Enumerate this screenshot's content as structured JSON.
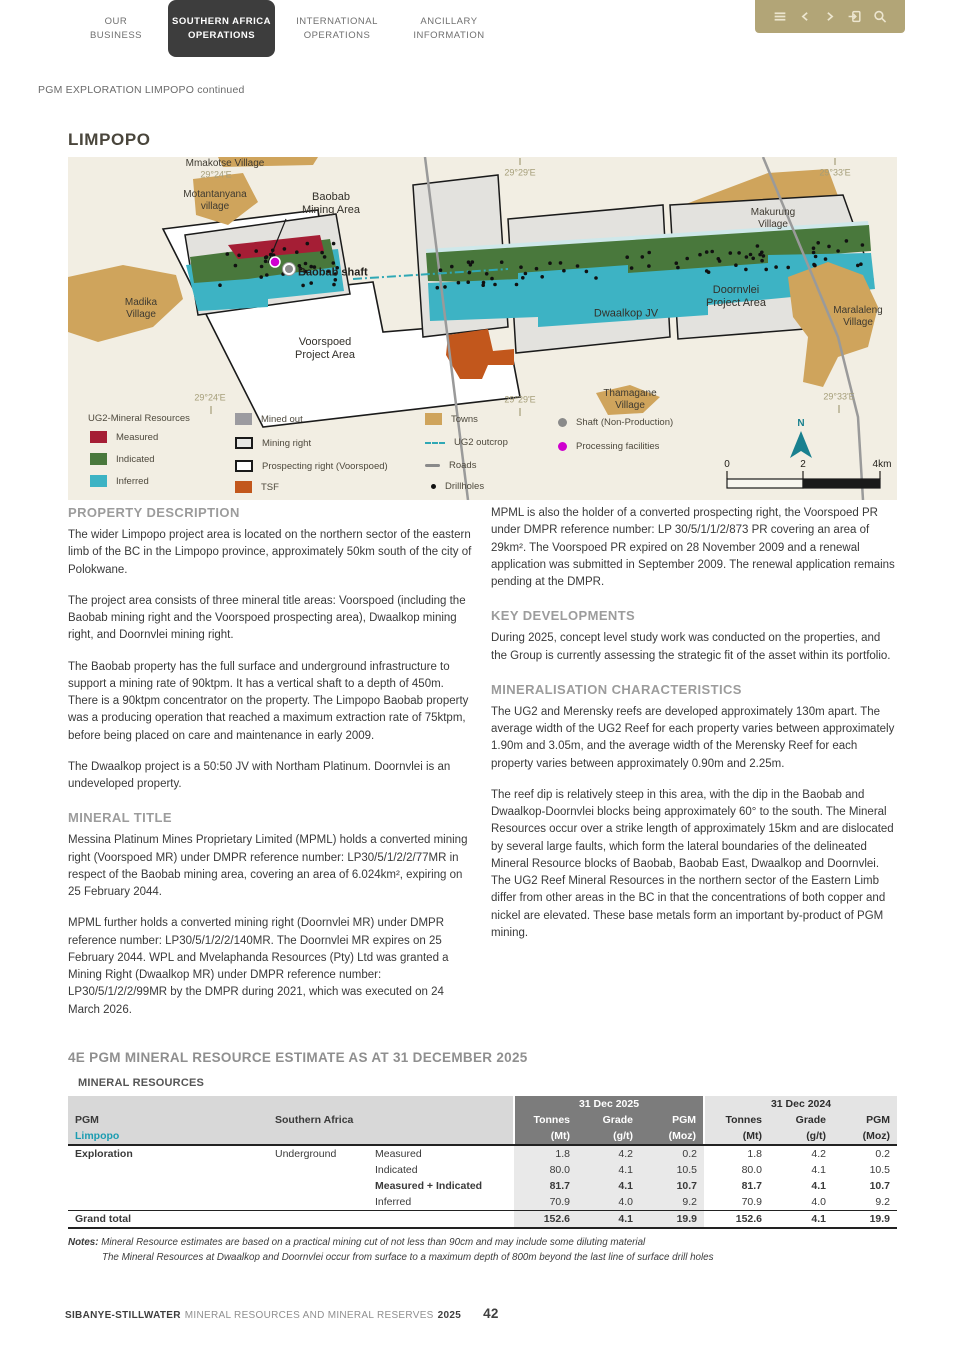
{
  "nav": {
    "tabs": [
      {
        "label": "OUR\nBUSINESS"
      },
      {
        "label": "SOUTHERN AFRICA\nOPERATIONS"
      },
      {
        "label": "INTERNATIONAL\nOPERATIONS"
      },
      {
        "label": "ANCILLARY\nINFORMATION"
      }
    ],
    "toolbar_icons": [
      "menu-icon",
      "chevron-left-icon",
      "chevron-right-icon",
      "exit-icon",
      "search-icon"
    ]
  },
  "breadcrumb": "PGM EXPLORATION LIMPOPO continued",
  "page": {
    "title": "LIMPOPO"
  },
  "colors": {
    "accent_gold": "#b2a577",
    "tab_active": "#3d3d3d",
    "teal_accent": "#1b9cb1",
    "measured": "#a51e35",
    "indicated": "#49783c",
    "inferred": "#3db3c4",
    "tsf": "#c2571c",
    "towns": "#cfa45c"
  },
  "map": {
    "grid_top": [
      "29°24'E",
      "29°29'E",
      "29°33'E"
    ],
    "grid_bottom": [
      "29°24'E",
      "29°29'E",
      "29°33'E"
    ],
    "labels": {
      "mmakotse": "Mmakotse Village",
      "motantanyana": "Motantanyana\nvillage",
      "baobab_area": "Baobab\nMining Area",
      "baobab_shaft": "Baobab shaft",
      "madika": "Madika\nVillage",
      "makurung": "Makurung\nVillage",
      "maralaleng": "Maralaleng\nVillage",
      "thamagane": "Thamagane\nVillage",
      "dwaalkop": "Dwaalkop JV",
      "doornvlei": "Doornvlei\nProject Area",
      "voorspoed": "Voorspoed\nProject Area"
    },
    "legend": {
      "header": "UG2-Mineral Resources",
      "measured": "Measured",
      "indicated": "Indicated",
      "inferred": "Inferred",
      "mined_out": "Mined out",
      "mining_right": "Mining right",
      "prospecting_right": "Prospecting right (Voorspoed)",
      "tsf": "TSF",
      "towns": "Towns",
      "ug2_outcrop": "UG2 outcrop",
      "roads": "Roads",
      "drillholes": "Drillholes",
      "shaft": "Shaft (Non-Production)",
      "processing": "Processing facilities"
    },
    "north": "N",
    "scale": {
      "zero": "0",
      "two": "2",
      "four": "4km"
    }
  },
  "sections": {
    "left": [
      {
        "heading": "PROPERTY DESCRIPTION",
        "paragraphs": [
          "The wider Limpopo project area is located on the northern sector of the eastern limb of the BC in the Limpopo province, approximately 50km south of the city of Polokwane.",
          "The project area consists of three mineral title areas: Voorspoed (including the Baobab mining right and the Voorspoed prospecting area), Dwaalkop mining right, and Doornvlei mining right.",
          "The Baobab property has the full surface and underground infrastructure to support a mining rate of 90ktpm. It has a vertical shaft to a depth of 450m. There is a 90ktpm concentrator on the property. The Limpopo Baobab property was a producing operation that reached a maximum extraction rate of 75ktpm, before being placed on care and maintenance in early 2009.",
          "The Dwaalkop project is a 50:50 JV with Northam Platinum. Doornvlei is an undeveloped property."
        ]
      },
      {
        "heading": "MINERAL TITLE",
        "paragraphs": [
          "Messina Platinum Mines Proprietary Limited (MPML) holds a converted mining right (Voorspoed MR) under DMPR reference number: LP30/5/1/2/2/77MR in respect of the Baobab mining area, covering an area of 6.024km², expiring on 25 February 2044.",
          "MPML further holds a converted mining right (Doornvlei MR) under DMPR reference number: LP30/5/1/2/2/140MR. The Doornvlei MR expires on 25 February 2044. WPL and Mvelaphanda Resources (Pty) Ltd was granted a Mining Right (Dwaalkop MR) under DMPR reference number: LP30/5/1/2/2/99MR by the DMPR during 2021, which was executed on 24 March 2026."
        ]
      }
    ],
    "right": [
      {
        "heading": "",
        "paragraphs": [
          "MPML is also the holder of a converted prospecting right, the Voorspoed PR under DMPR reference number: LP 30/5/1/1/2/873 PR covering an area of 29km². The Voorspoed PR expired on 28 November 2009 and a renewal application was submitted in September 2009. The renewal application remains pending at the DMPR."
        ]
      },
      {
        "heading": "KEY DEVELOPMENTS",
        "paragraphs": [
          "During 2025, concept level study work was conducted on the properties, and the Group is currently assessing the strategic fit of the asset within its portfolio."
        ]
      },
      {
        "heading": "MINERALISATION CHARACTERISTICS",
        "paragraphs": [
          "The UG2 and Merensky reefs are developed approximately 130m apart. The average width of the UG2 Reef for each property varies between approximately 1.90m and 3.05m, and the average width of the Merensky Reef for each property varies between approximately 0.90m and 2.25m.",
          "The reef dip is relatively steep in this area, with the dip in the Baobab and Dwaalkop-Doornvlei blocks being approximately 60° to the south. The Mineral Resources occur over a strike length of approximately 15km and are dislocated by several large faults, which form the lateral boundaries of the delineated Mineral Resource blocks of Baobab, Baobab East, Dwaalkop and Doornvlei. The UG2 Reef Mineral Resources in the northern sector of the Eastern Limb differ from other areas in the BC in that the concentrations of both copper and nickel are elevated. These base metals form an important by-product of PGM mining."
        ]
      }
    ]
  },
  "resource_table": {
    "title": "4E PGM MINERAL RESOURCE ESTIMATE AS AT 31 DECEMBER 2025",
    "subtitle": "MINERAL RESOURCES",
    "group_label": "PGM",
    "region_label": "Southern Africa",
    "area_label": "Limpopo",
    "period_2025": "31 Dec 2025",
    "period_2024": "31 Dec 2024",
    "col_headers": {
      "tonnes": "Tonnes",
      "grade": "Grade",
      "pgm": "PGM",
      "mt": "(Mt)",
      "gt": "(g/t)",
      "moz": "(Moz)"
    },
    "rows": [
      {
        "section": "Exploration",
        "mining": "Underground",
        "category": "Measured",
        "v": [
          "1.8",
          "4.2",
          "0.2",
          "1.8",
          "4.2",
          "0.2"
        ]
      },
      {
        "section": "",
        "mining": "",
        "category": "Indicated",
        "v": [
          "80.0",
          "4.1",
          "10.5",
          "80.0",
          "4.1",
          "10.5"
        ]
      },
      {
        "section": "",
        "mining": "",
        "category": "Measured + Indicated",
        "v": [
          "81.7",
          "4.1",
          "10.7",
          "81.7",
          "4.1",
          "10.7"
        ]
      },
      {
        "section": "",
        "mining": "",
        "category": "Inferred",
        "v": [
          "70.9",
          "4.0",
          "9.2",
          "70.9",
          "4.0",
          "9.2"
        ]
      }
    ],
    "grand_total": {
      "label": "Grand total",
      "v": [
        "152.6",
        "4.1",
        "19.9",
        "152.6",
        "4.1",
        "19.9"
      ]
    },
    "notes": {
      "label": "Notes:",
      "line1": "Mineral Resource estimates are based on a practical mining cut of not less than 90cm and may include some diluting material",
      "line2": "The Mineral Resources at Dwaalkop and Doornvlei occur from surface to a maximum depth of 800m beyond the last line of surface drill holes"
    }
  },
  "footer": {
    "brand": "SIBANYE-STILLWATER",
    "rest": "MINERAL RESOURCES AND MINERAL RESERVES",
    "year": "2025",
    "page_number": "42"
  }
}
